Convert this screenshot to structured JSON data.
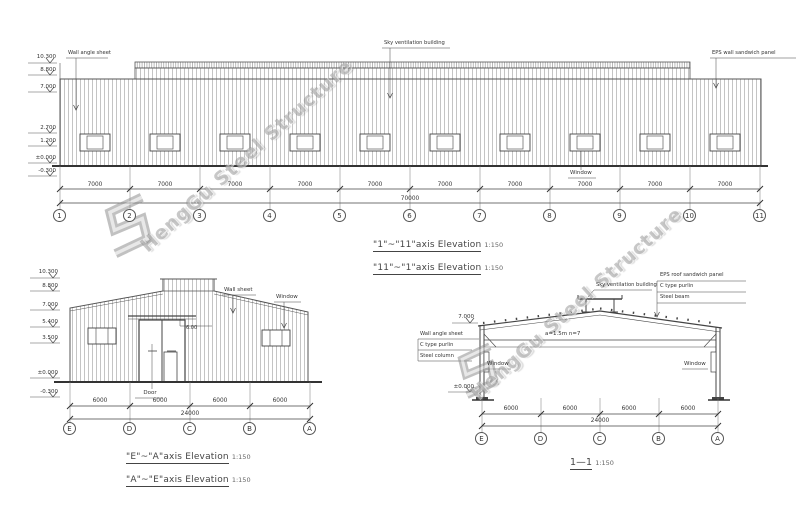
{
  "watermark": {
    "text": "HengGu Steel Structure"
  },
  "top_elevation": {
    "levels": [
      "10.300",
      "8.800",
      "7.000",
      "2.700",
      "1.200",
      "±0.000",
      "-0.300"
    ],
    "labels": {
      "wall_angle_sheet": "Wall angle sheet",
      "ridge_vent": "Sky ventilation building",
      "eps_panel": "EPS wall sandwich panel",
      "window": "Window"
    },
    "bay_dims": [
      "7000",
      "7000",
      "7000",
      "7000",
      "7000",
      "7000",
      "7000",
      "7000",
      "7000",
      "7000"
    ],
    "total_dim": "70000",
    "axes": [
      "1",
      "2",
      "3",
      "4",
      "5",
      "6",
      "7",
      "8",
      "9",
      "10",
      "11"
    ],
    "titles": [
      {
        "name": "\"1\"~\"11\"axis Elevation",
        "scale": "1:150"
      },
      {
        "name": "\"11\"~\"1\"axis Elevation",
        "scale": "1:150"
      }
    ]
  },
  "gable_elevation": {
    "levels": [
      "10.300",
      "8.800",
      "7.000",
      "5.400",
      "3.500",
      "±0.000",
      "-0.300"
    ],
    "labels": {
      "wall_sheet": "Wall sheet",
      "window": "Window",
      "door": "Door",
      "canopy_dim": "6.00"
    },
    "bay_dims": [
      "6000",
      "6000",
      "6000",
      "6000"
    ],
    "total_dim": "24000",
    "axes": [
      "E",
      "D",
      "C",
      "B",
      "A"
    ],
    "titles": [
      {
        "name": "\"E\"~\"A\"axis Elevation",
        "scale": "1:150"
      },
      {
        "name": "\"A\"~\"E\"axis Elevation",
        "scale": "1:150"
      }
    ]
  },
  "section": {
    "levels": [
      "7.000",
      "±0.000"
    ],
    "labels": {
      "ridge_vent": "Sky ventilation building",
      "purlin_note": "a=1.5m n=7",
      "window_left": "Window",
      "window_right": "Window"
    },
    "roof_stack": [
      "EPS roof sandwich panel",
      "C type purlin",
      "Steel beam"
    ],
    "column_stack": [
      "Wall angle sheet",
      "C type purlin",
      "Steel column"
    ],
    "bay_dims": [
      "6000",
      "6000",
      "6000",
      "6000"
    ],
    "total_dim": "24000",
    "axes": [
      "E",
      "D",
      "C",
      "B",
      "A"
    ],
    "title": {
      "name": "1—1",
      "scale": "1:150"
    }
  }
}
